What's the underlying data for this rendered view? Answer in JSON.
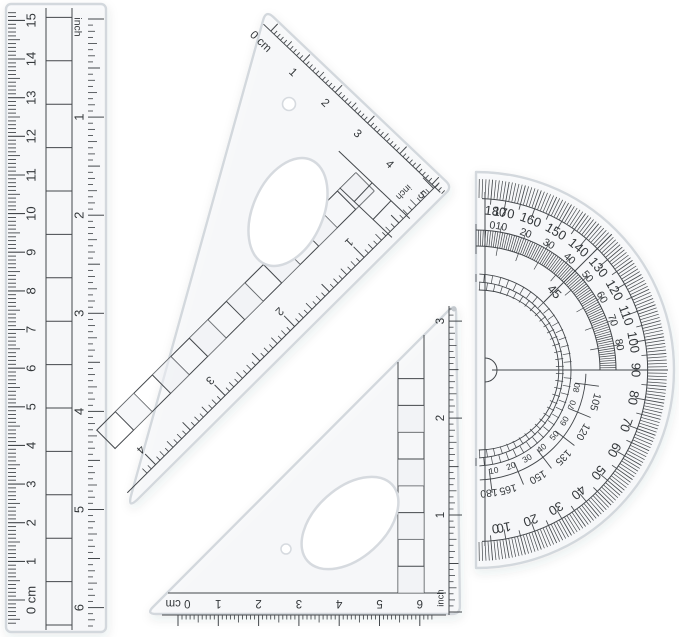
{
  "scene": {
    "description": "Transparent plastic geometry set: ruler, two set squares, protractor",
    "background": "#ffffff",
    "ink": "#34383b",
    "tick_ink": "#43474b",
    "plastic_edge": "#d3d8dd",
    "plastic_fill": "rgba(246,248,250,0.6)",
    "hole_edge": "#d6dadf"
  },
  "ruler": {
    "unit_label": "inch",
    "cm_numbers": [
      "0 cm",
      "1",
      "2",
      "3",
      "4",
      "5",
      "6",
      "7",
      "8",
      "9",
      "10",
      "11",
      "12",
      "13",
      "14",
      "15"
    ],
    "inch_numbers": [
      "1",
      "2",
      "3",
      "4",
      "5",
      "6"
    ]
  },
  "large_set_square": {
    "cm_numbers": [
      "0 cm",
      "1",
      "2",
      "3",
      "4",
      "5"
    ],
    "inch_unit_label": "inch",
    "inch_numbers": [
      "1",
      "2",
      "3",
      "4"
    ]
  },
  "small_set_square": {
    "cm_numbers": [
      "0 cm",
      "1",
      "2",
      "3",
      "4",
      "5",
      "6"
    ],
    "inch_unit_label": "inch",
    "inch_numbers": [
      "1",
      "2",
      "3"
    ]
  },
  "protractor": {
    "outer_numbers": [
      "180",
      "170",
      "160",
      "150",
      "140",
      "130",
      "120",
      "110",
      "100",
      "90",
      "80",
      "70",
      "60",
      "50",
      "40",
      "30",
      "20",
      "10",
      "0"
    ],
    "inner_upper_numbers": [
      "0",
      "10",
      "20",
      "30",
      "40",
      "50",
      "60",
      "70",
      "80"
    ],
    "inner_lower_numbers": [
      "105",
      "120",
      "135",
      "150",
      "165",
      "180"
    ],
    "reverse_lower_numbers": [
      "10",
      "20",
      "30",
      "40",
      "50",
      "60",
      "70",
      "80"
    ],
    "diagonal_label": "45"
  }
}
